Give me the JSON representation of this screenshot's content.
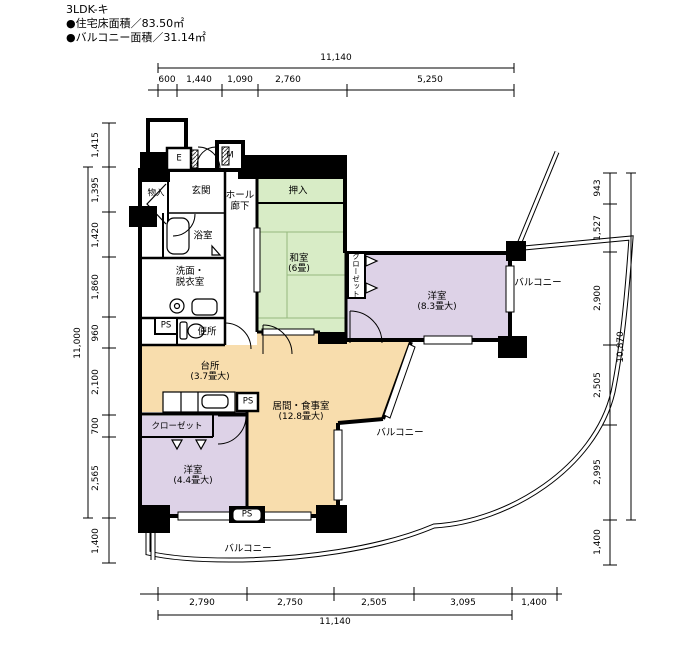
{
  "header": {
    "title": "3LDK-キ",
    "floor_area": "●住宅床面積／83.50㎡",
    "balcony_area": "●バルコニー面積／31.14㎡"
  },
  "dimensions": {
    "top": {
      "total": "11,140",
      "segments": [
        "600",
        "1,440",
        "1,090",
        "2,760",
        "5,250"
      ]
    },
    "bottom": {
      "total": "11,140",
      "segments": [
        "2,790",
        "2,750",
        "2,505",
        "3,095",
        "1,400"
      ]
    },
    "left": {
      "total": "11,000",
      "segments": [
        "1,415",
        "1,395",
        "1,420",
        "1,860",
        "960",
        "2,100",
        "700",
        "2,565",
        "1,400"
      ]
    },
    "right": {
      "total": "10,870",
      "segments": [
        "943",
        "1,527",
        "2,900",
        "2,505",
        "2,995",
        "1,400"
      ]
    }
  },
  "rooms": {
    "entrance": "玄関",
    "storage": "物入",
    "hall_line1": "ホール",
    "hall_line2": "廊下",
    "oshiire": "押入",
    "washitsu_name": "和室",
    "washitsu_size": "(6畳)",
    "bath": "浴室",
    "washroom_line1": "洗面・",
    "washroom_line2": "脱衣室",
    "toilet": "便所",
    "kitchen_name": "台所",
    "kitchen_size": "(3.7畳大)",
    "living_name": "居間・食事室",
    "living_size": "(12.8畳大)",
    "bedroom1_name": "洋室",
    "bedroom1_size": "(8.3畳大)",
    "bedroom2_name": "洋室",
    "bedroom2_size": "(4.4畳大)",
    "closet": "クローゼット",
    "balcony": "バルコニー"
  },
  "labels": {
    "ps": "PS",
    "elevator": "E",
    "meter": "M"
  },
  "colors": {
    "tatami": "#d8ecc6",
    "western": "#ddd2e7",
    "ldk": "#f8ddad",
    "wall": "#000000"
  }
}
